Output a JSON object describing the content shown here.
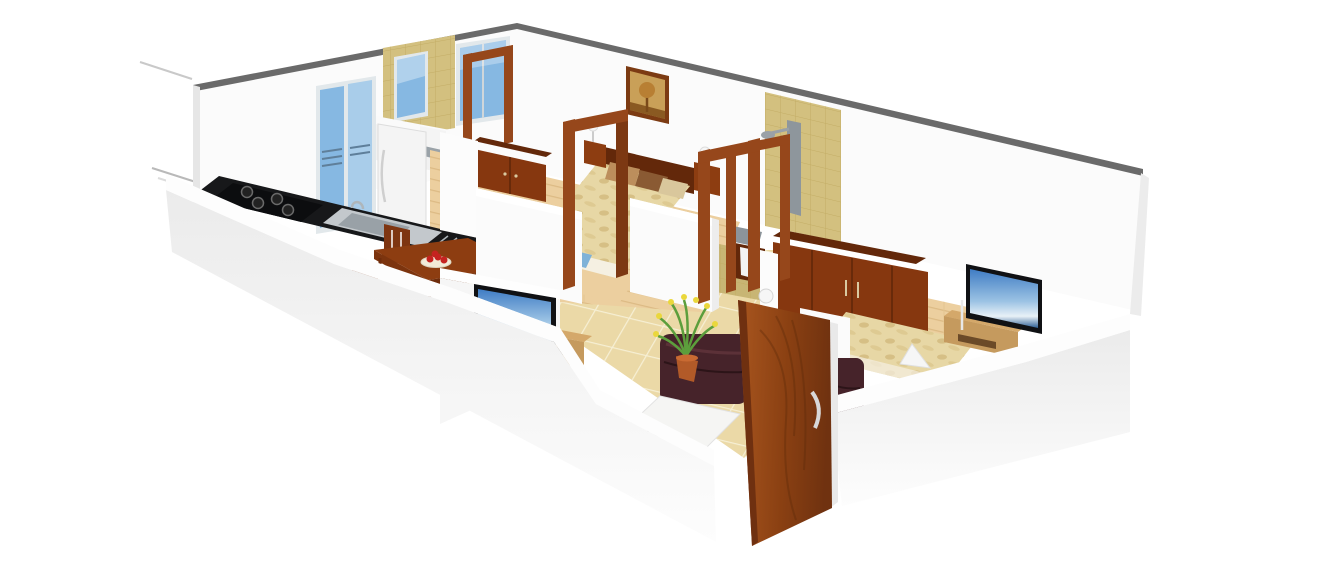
{
  "figure": {
    "type": "3d-isometric-floor-plan",
    "description": "3D rendered floor plan of a 2BHK apartment viewed from above at an angle, white cut walls, furnished rooms",
    "rooms": [
      "kitchen",
      "dining-area",
      "living-room",
      "hall",
      "bedroom-1",
      "bathroom-1",
      "bedroom-2",
      "bathroom-2"
    ],
    "inventory": {
      "kitchen": [
        "gas-stove",
        "kitchen-sink",
        "black-counter",
        "refrigerator",
        "blue-glass-balcony-door"
      ],
      "dining_area": [
        "wooden-dining-table",
        "four-chairs",
        "fruit-plate-with-red-apples"
      ],
      "living_room": [
        "dark-leather-sofa",
        "white-coffee-table",
        "flat-tv",
        "wooden-tv-stand",
        "potted-plant-yellow-flowers",
        "main-entrance-wooden-door"
      ],
      "bedroom_1": [
        "double-bed-beige-spread",
        "pillows",
        "wooden-wardrobe",
        "bedside-lamps",
        "tree-wall-painting",
        "open-door-frame",
        "wood-plank-floor",
        "blue-window"
      ],
      "bathroom_1": [
        "tan-tiled-wall",
        "blue-window",
        "wash-basin"
      ],
      "bedroom_2": [
        "double-bed-beige-spread",
        "long-wooden-wardrobe",
        "flat-tv",
        "wooden-tv-stand",
        "white-decor-object"
      ],
      "bathroom_2": [
        "tan-tile-shower-wall",
        "gray-shower-panel",
        "wash-basin",
        "double-door-frames",
        "white-door-knob"
      ]
    }
  },
  "colors": {
    "background": "#ffffff",
    "wall": "#fbfbfb",
    "wall_bright": "#fdfdfd",
    "wall_edge": "#6a6a6a",
    "wall_side": "#ececec",
    "tile_tan": "#d3c07f",
    "tile_tan_floor": "#c8b574",
    "floor_tile": "#ebd9a7",
    "wood_floor": "#eccf9f",
    "door_wood": "#96471b",
    "furniture_wood": "#86370f",
    "furniture_wood_dark": "#63280a",
    "table_wood": "#8d3d11",
    "chair_wood": "#7e3511",
    "stand_wood": "#c59a5e",
    "sofa": "#46232a",
    "tv_black": "#101114",
    "counter_black": "#17181a",
    "stove_black": "#0c0d0f",
    "steel": "#c3c8cc",
    "basin_gray": "#8c949a",
    "shower_gray": "#8e969c",
    "fridge_white": "#f4f4f4",
    "glass_blue": "#86b8e2",
    "glass_frame": "#e2e8eb",
    "plant_green": "#5c9e3c",
    "flower_yellow": "#ead73c",
    "pot_terracotta": "#b25a28",
    "apple_red": "#c52320",
    "plate_cream": "#f2ebd7",
    "blanket": "#e7d7a5",
    "pillow_tan": "#bc8e5c",
    "pillow_brown": "#8a5a33",
    "pillow_cream": "#d9c79c",
    "lamp_white": "#f6f6f6",
    "mat_blue": "#7fb2d8",
    "coffee_table_white": "#f5f5f3",
    "art_frame": "#7c3b13",
    "art_gold": "#c9a058"
  }
}
